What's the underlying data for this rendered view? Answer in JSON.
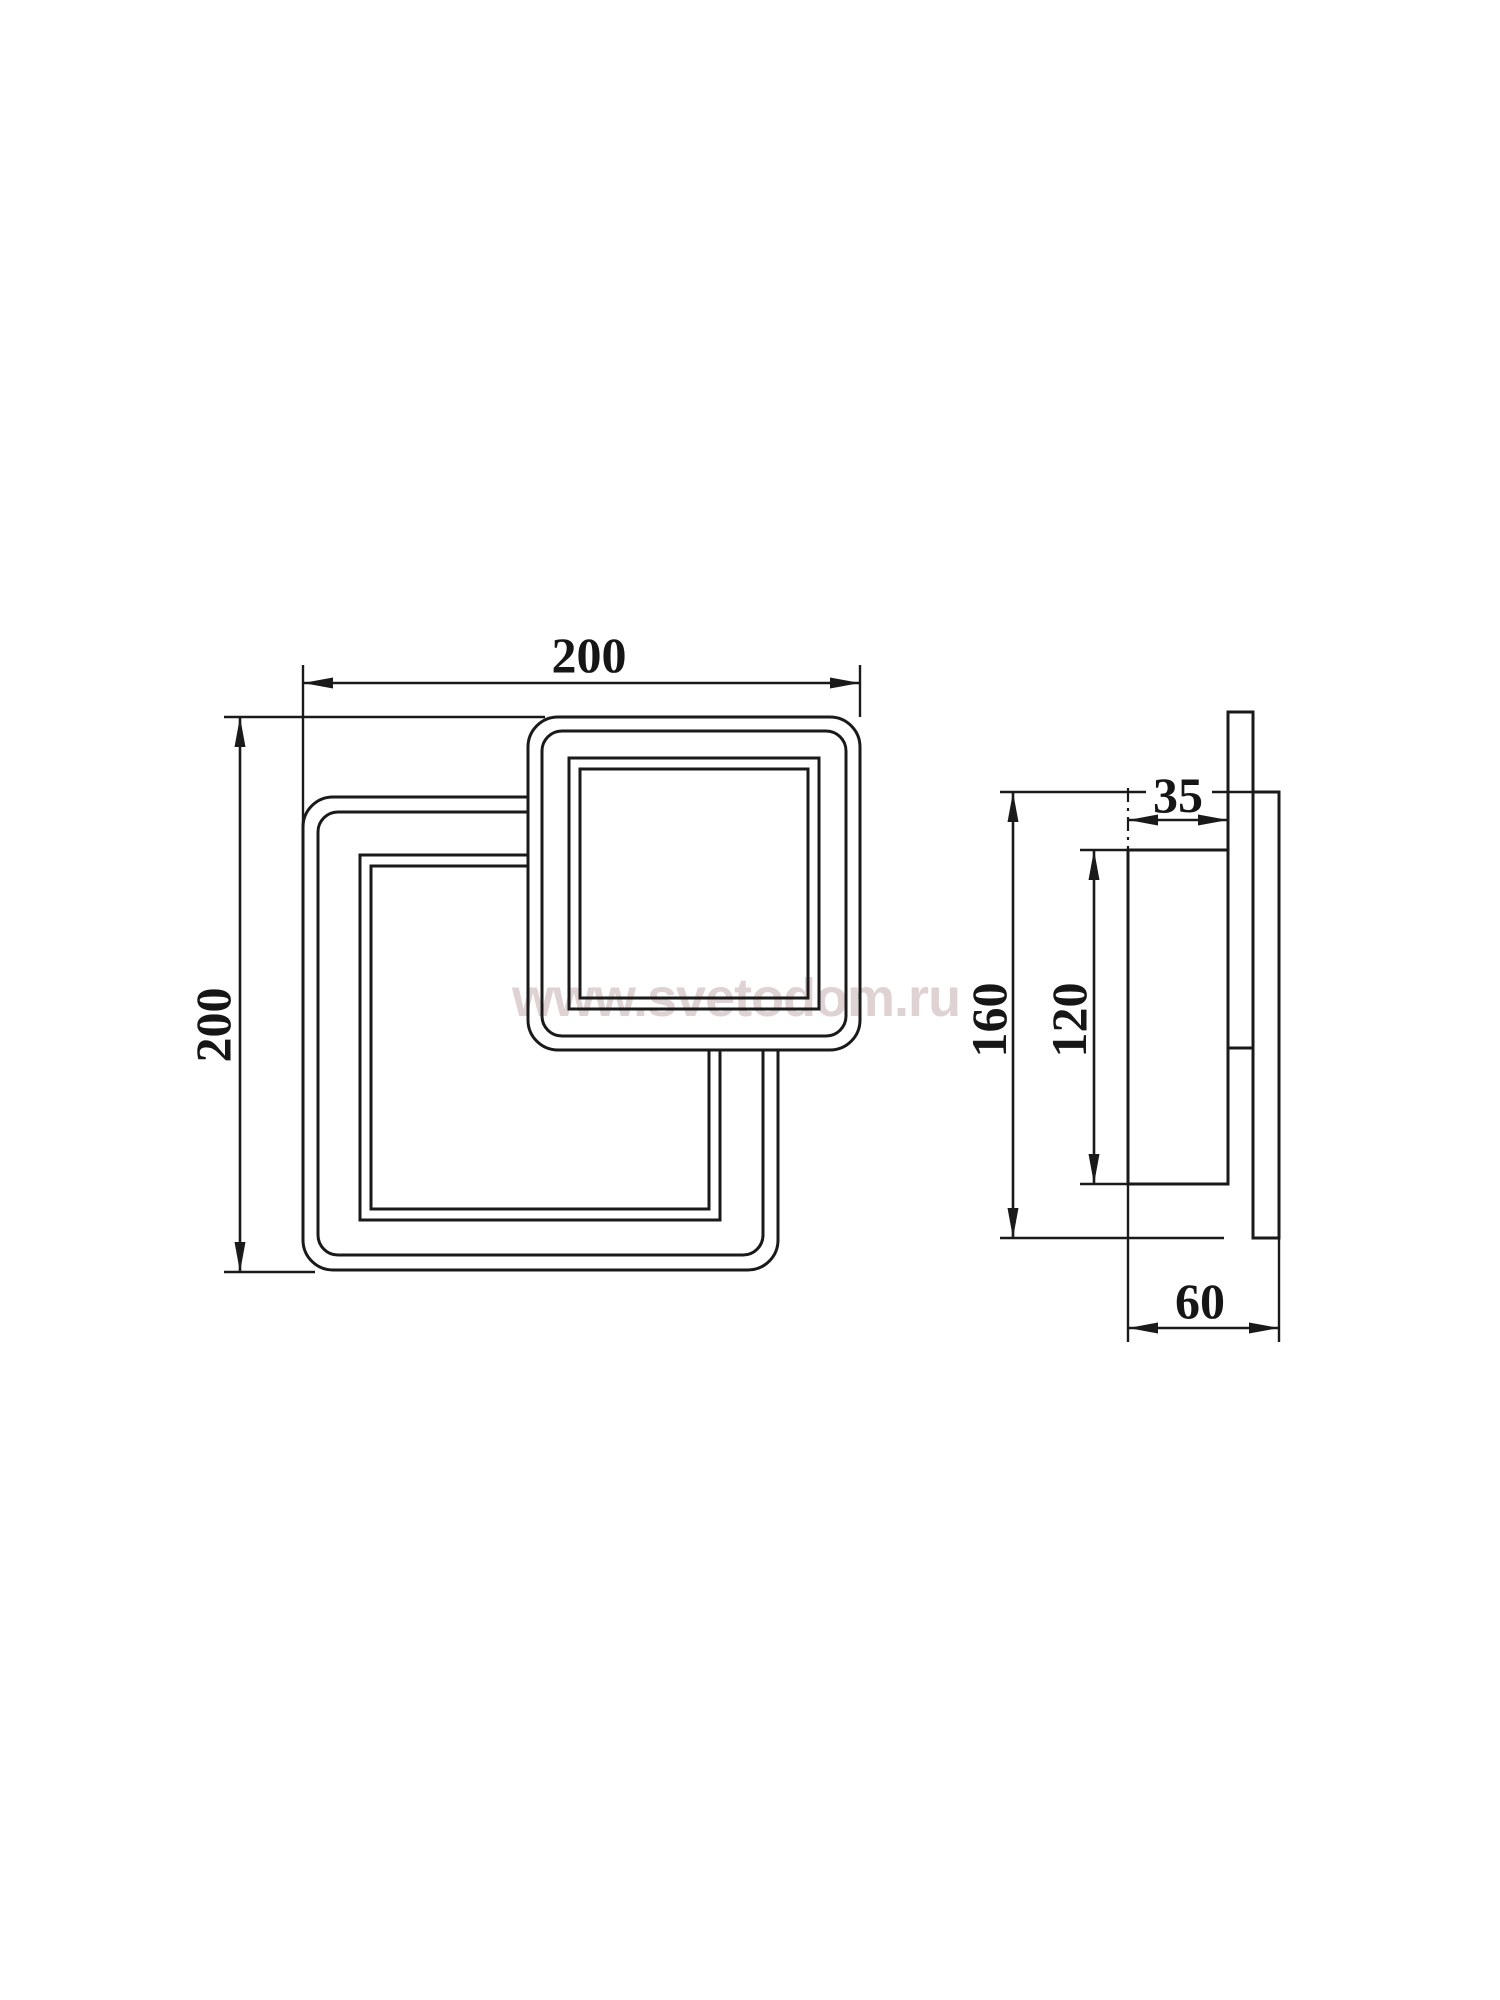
{
  "page": {
    "type": "technical dimension drawing of a square LED wall lamp",
    "background": "#ffffff",
    "line_color": "#1a1a1a"
  },
  "watermark": {
    "text": "www.svetodom.ru",
    "color": "#d7c7c7"
  },
  "views": {
    "front": {
      "width_mm": "200",
      "height_mm": "200"
    },
    "side": {
      "protrusion_mm": "35",
      "height_mm": "160",
      "bracket_height_mm": "120",
      "depth_mm": "60"
    }
  }
}
